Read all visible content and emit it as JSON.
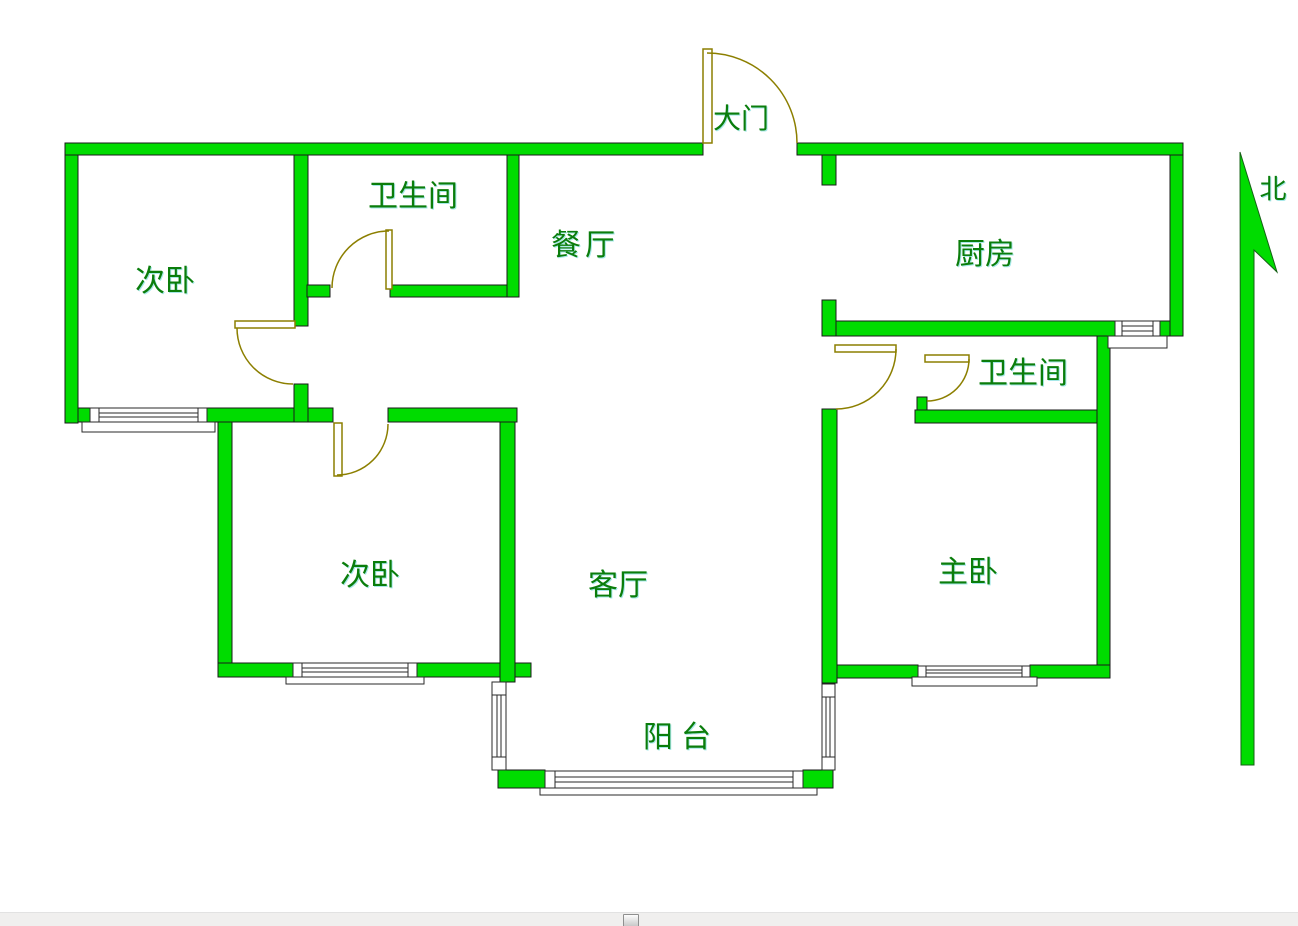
{
  "floor_plan": {
    "type": "apartment-floor-plan",
    "labels": {
      "main_door": "大门",
      "bathroom_top": "卫生间",
      "dining_room": "餐厅",
      "kitchen": "厨房",
      "north": "北",
      "bedroom_top_left": "次卧",
      "bathroom_right": "卫生间",
      "bedroom_bottom_left": "次卧",
      "living_room": "客厅",
      "master_bedroom": "主卧",
      "balcony": "阳台"
    },
    "colors": {
      "wall_fill": "#00dc00",
      "wall_outline": "#1a1a1a",
      "door_line": "#8c7f00",
      "window_fill": "#ffffff",
      "window_outline": "#2a2a2a",
      "label_text": "#0b7d0b"
    }
  },
  "scrollbar": {
    "orientation": "horizontal",
    "track_color": "#f0efee",
    "thumb_border": "#8f8f8f"
  }
}
